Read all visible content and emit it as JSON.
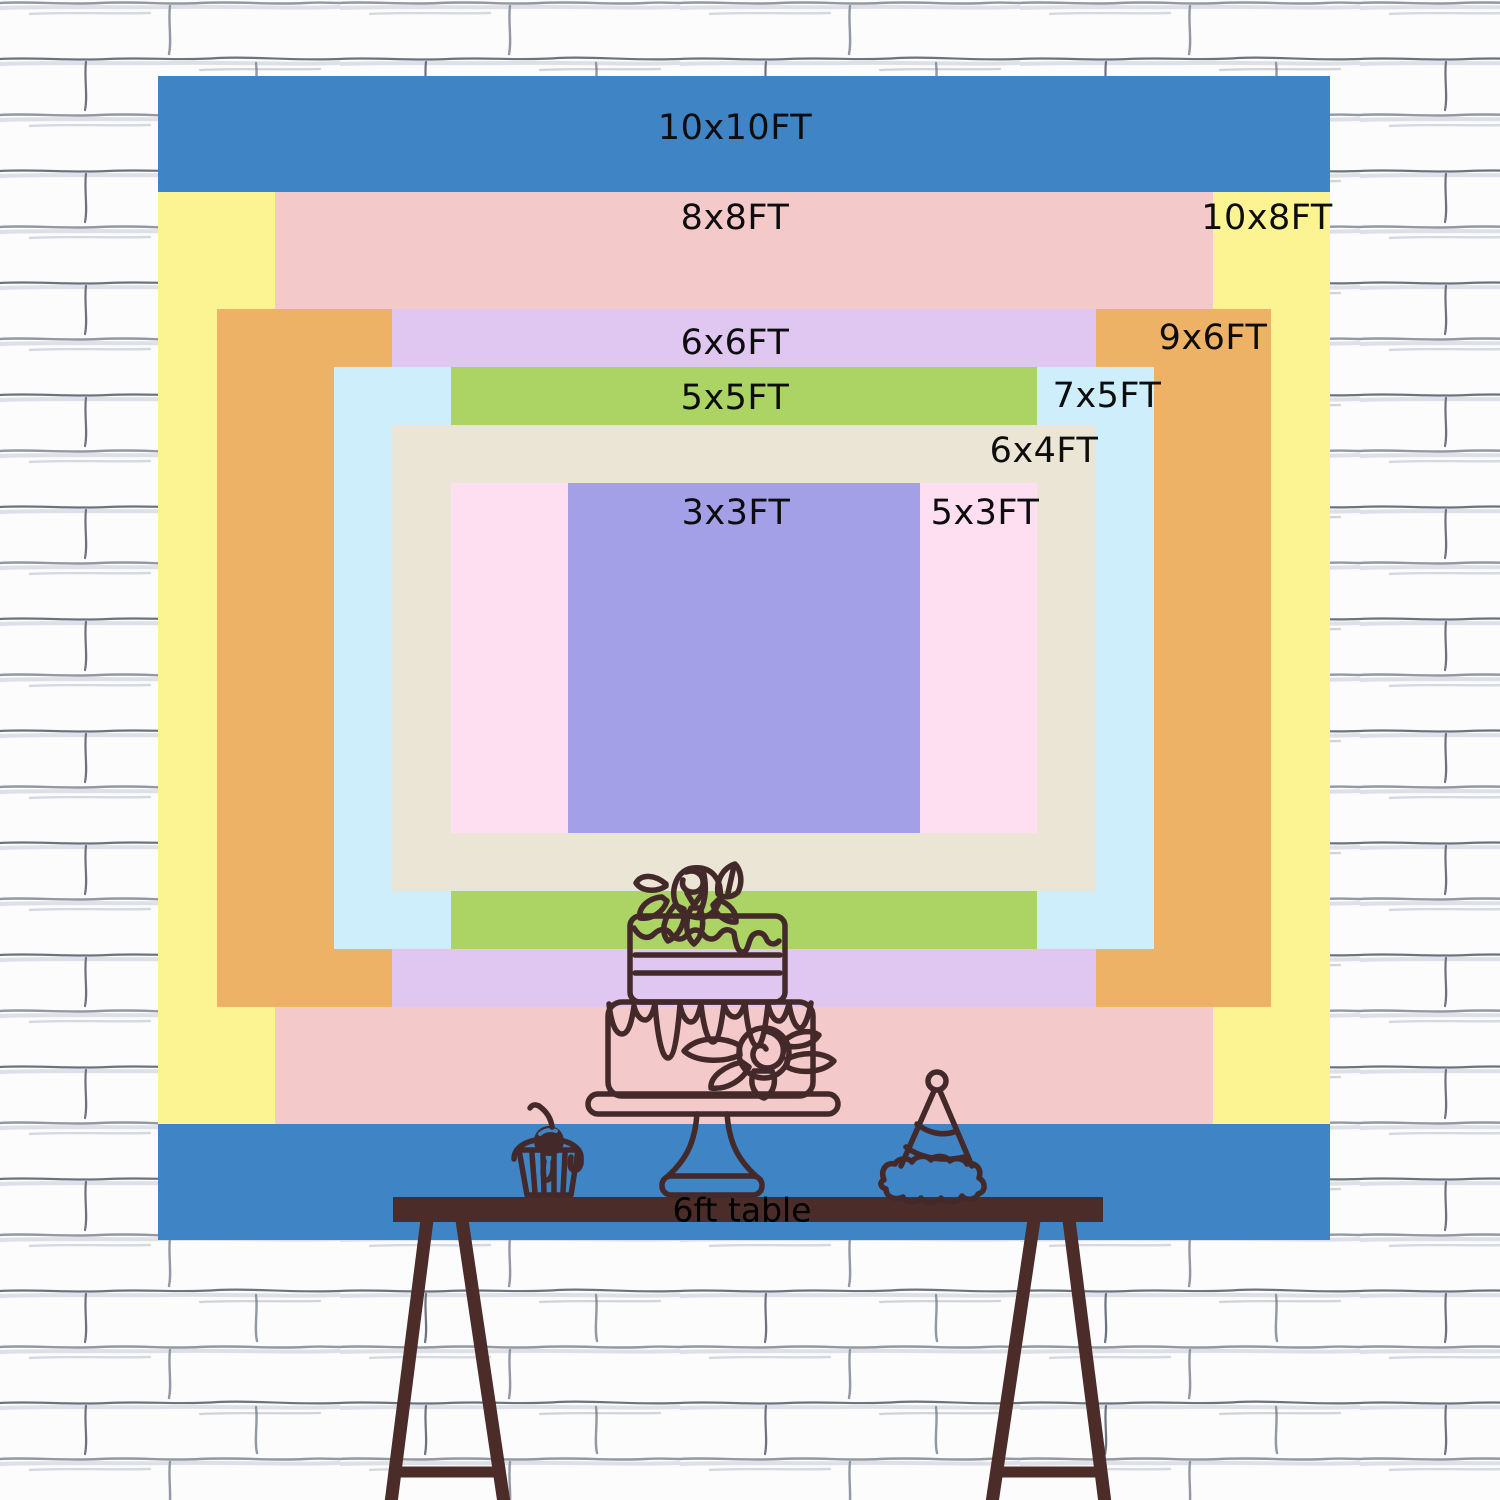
{
  "canvas": {
    "width_px": 1500,
    "height_px": 1500,
    "background_style": "white painted brick wall sketch",
    "background_base_color": "#fcfcfd",
    "mortar_line_color": "#9298a4"
  },
  "size_chart": {
    "unit": "FT",
    "label_text_color": "#0d0d0d",
    "layers": [
      {
        "id": "10x10ft",
        "label": "10x10FT",
        "width_ft": 10,
        "height_ft": 10,
        "color": "#3f84c4",
        "label_pos": {
          "x": 735,
          "y": 128
        }
      },
      {
        "id": "10x8ft",
        "label": "10x8FT",
        "width_ft": 10,
        "height_ft": 8,
        "color": "#fcf493",
        "label_pos": {
          "x": 1267,
          "y": 218
        }
      },
      {
        "id": "8x8ft",
        "label": "8x8FT",
        "width_ft": 8,
        "height_ft": 8,
        "color": "#f4c9ca",
        "label_pos": {
          "x": 735,
          "y": 218
        }
      },
      {
        "id": "9x6ft",
        "label": "9x6FT",
        "width_ft": 9,
        "height_ft": 6,
        "color": "#edb265",
        "label_pos": {
          "x": 1213,
          "y": 338
        }
      },
      {
        "id": "6x6ft",
        "label": "6x6FT",
        "width_ft": 6,
        "height_ft": 6,
        "color": "#dfc7f1",
        "label_pos": {
          "x": 735,
          "y": 343
        }
      },
      {
        "id": "7x5ft",
        "label": "7x5FT",
        "width_ft": 7,
        "height_ft": 5,
        "color": "#cdeefa",
        "label_pos": {
          "x": 1107,
          "y": 396
        }
      },
      {
        "id": "5x5ft",
        "label": "5x5FT",
        "width_ft": 5,
        "height_ft": 5,
        "color": "#abd464",
        "label_pos": {
          "x": 735,
          "y": 398
        }
      },
      {
        "id": "6x4ft",
        "label": "6x4FT",
        "width_ft": 6,
        "height_ft": 4,
        "color": "#ebe5d5",
        "label_pos": {
          "x": 1044,
          "y": 451
        }
      },
      {
        "id": "5x3ft",
        "label": "5x3FT",
        "width_ft": 5,
        "height_ft": 3,
        "color": "#fedff1",
        "label_pos": {
          "x": 985,
          "y": 513
        }
      },
      {
        "id": "3x3ft",
        "label": "3x3FT",
        "width_ft": 3,
        "height_ft": 3,
        "color": "#a3a0e8",
        "label_pos": {
          "x": 736,
          "y": 513
        }
      }
    ]
  },
  "table": {
    "label": "6ft table",
    "color": "#4b2c28",
    "label_color": "#000000"
  },
  "illustrations": {
    "line_color": "#44292a",
    "items": [
      "two-tier-drip-cake-on-stand",
      "cupcake-with-cherry",
      "party-hat"
    ]
  }
}
